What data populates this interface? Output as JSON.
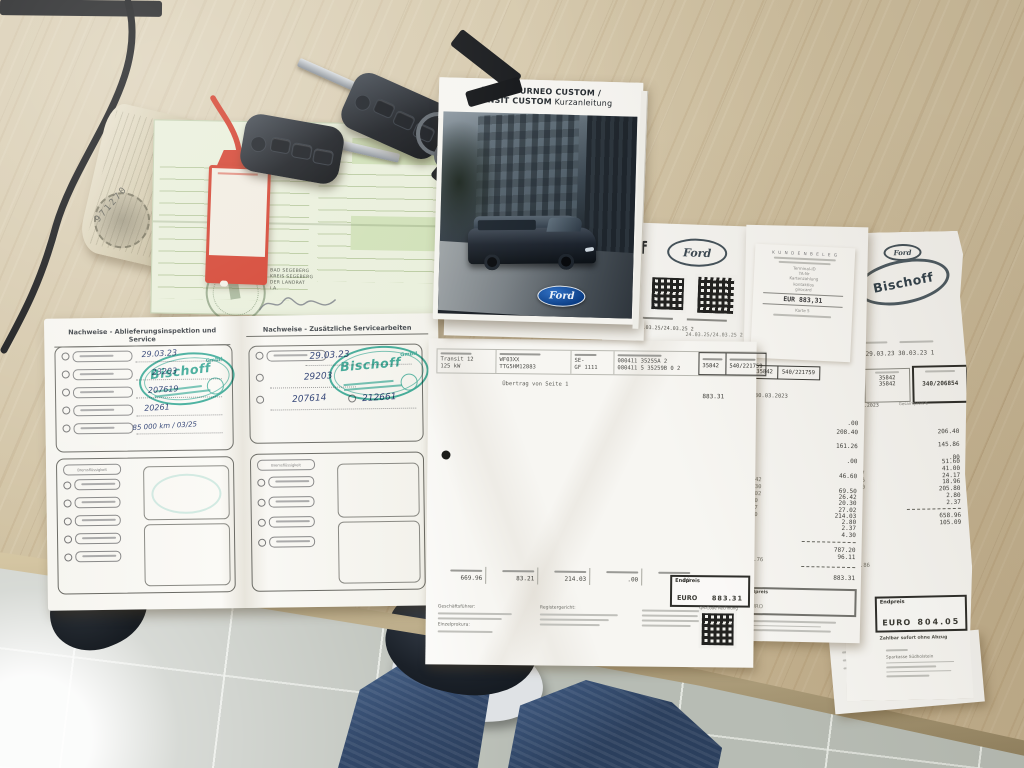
{
  "palette": {
    "wood": "#cfc0a0",
    "floor": "#b7bcb4",
    "ford_blue": "#1256a8",
    "stamp_teal": "#18a08c",
    "tag_red": "#d4402e",
    "denim": "#3f5d85"
  },
  "booklet": {
    "brand": "FORD",
    "title": "TOURNEO CUSTOM /",
    "title2": "TRANSIT CUSTOM",
    "subtitle": "Kurzanleitung",
    "ford_logo": "Ford"
  },
  "green_doc": {
    "issuer1": "BAD SEGEBERG",
    "issuer2": "KREIS SEGEBERG",
    "issuer3": "DER LANDRAT",
    "issuer4": "i.A."
  },
  "rolled_doc": {
    "serial": "971270"
  },
  "service_book": {
    "left": {
      "header": "Nachweise - Ablieferungsinspektion und Service",
      "rows": [
        "29.03.23",
        "23203",
        "207619",
        "20261",
        "85 000 km / 03/25"
      ],
      "group2_label": "Bremsflüssigkeit"
    },
    "right": {
      "header": "Nachweise - Zusätzliche Servicearbeiten",
      "rows": [
        "29.03.23",
        "29203",
        "207614"
      ],
      "extra": "212661",
      "group2_label": "Bremsflüssigkeit"
    },
    "stamp": {
      "name": "Bischoff",
      "gmbh": "GmbH"
    }
  },
  "qr_sheet": {
    "logo_fragment": "off",
    "ford": "Ford",
    "dates": "24.03.25/24.03.25 2"
  },
  "invoice_main": {
    "model": "Transit 12",
    "power": "125 kW",
    "vin1": "WF03XX",
    "vin2": "TTG5HM12883",
    "c1": "SE-",
    "c2": "GF 1111",
    "r1": "080411  35255A 2",
    "r2": "080411 5 35259B 0 2",
    "order_no": "35842",
    "invoice_no": "540/221759",
    "carryover": "Übertrag von Seite 1",
    "carryover_value": "883.31",
    "totals": [
      "669.96",
      "83.21",
      "214.03",
      ".00",
      ".00"
    ],
    "endpreis": "Endpreis",
    "currency": "EURO",
    "total": "883.31",
    "f1": "Geschäftsführer:",
    "f2": "Einzelprokura:",
    "f3": "Registergericht:",
    "qr_label": "QR-Code Rechnung",
    "top_date": "24.03.25/24.03.25 2"
  },
  "receipt": {
    "title": "K U N D E N B E L E G",
    "t1": "Terminal-ID",
    "t2": "TA-Nr",
    "pay1": "Kartenzahlung",
    "pay2": "kontaktlos",
    "scheme": "girocard",
    "amount": "EUR 883,31",
    "card": "Karte 5"
  },
  "invoice_mid": {
    "box_order": "35842",
    "box_invoice": "540/221759",
    "date": "30.03.2023",
    "amounts_a": [
      ".00",
      "208.40"
    ],
    "amounts_b": [
      "161.26",
      ".00",
      "46.60",
      "69.50"
    ],
    "amounts_c": [
      "26.42",
      "20.30",
      "27.02",
      "214.03",
      "2.80",
      "2.37",
      "4.30"
    ],
    "left": [
      "26.42",
      "20.30",
      "27.02",
      "2.80",
      "2.37",
      "4.30"
    ],
    "left_total": "281.76",
    "net": "787.20",
    "tax": "96.11",
    "total": "883.31",
    "endpreis": "Endpreis",
    "currency": "EURO"
  },
  "invoice_right": {
    "ford": "Ford",
    "logo": "Bischoff",
    "dates": "29.03.23 30.03.23 1",
    "date2": "30.03.2023",
    "cell1": "2",
    "cell2": "0 8",
    "order1": "35842",
    "order2": "35842",
    "invoice_no": "340/206854",
    "total_label": "Gesamtpreis €",
    "amounts_a": [
      "206.40",
      "145.86",
      ".00"
    ],
    "amounts_b": [
      "51.60",
      "41.00",
      "24.17",
      "18.96",
      "205.80",
      "2.80",
      "2.37"
    ],
    "left": [
      "24.17",
      "18.96",
      "41.00",
      "2.80",
      "2.37"
    ],
    "left_extra": "145.86",
    "net": "658.96",
    "tax": "105.09",
    "endpreis": "Endpreis",
    "currency": "EURO",
    "total": "804.05",
    "pay_note": "Zahlbar sofort ohne Abzug",
    "bank": "Sparkasse Südholstein"
  }
}
